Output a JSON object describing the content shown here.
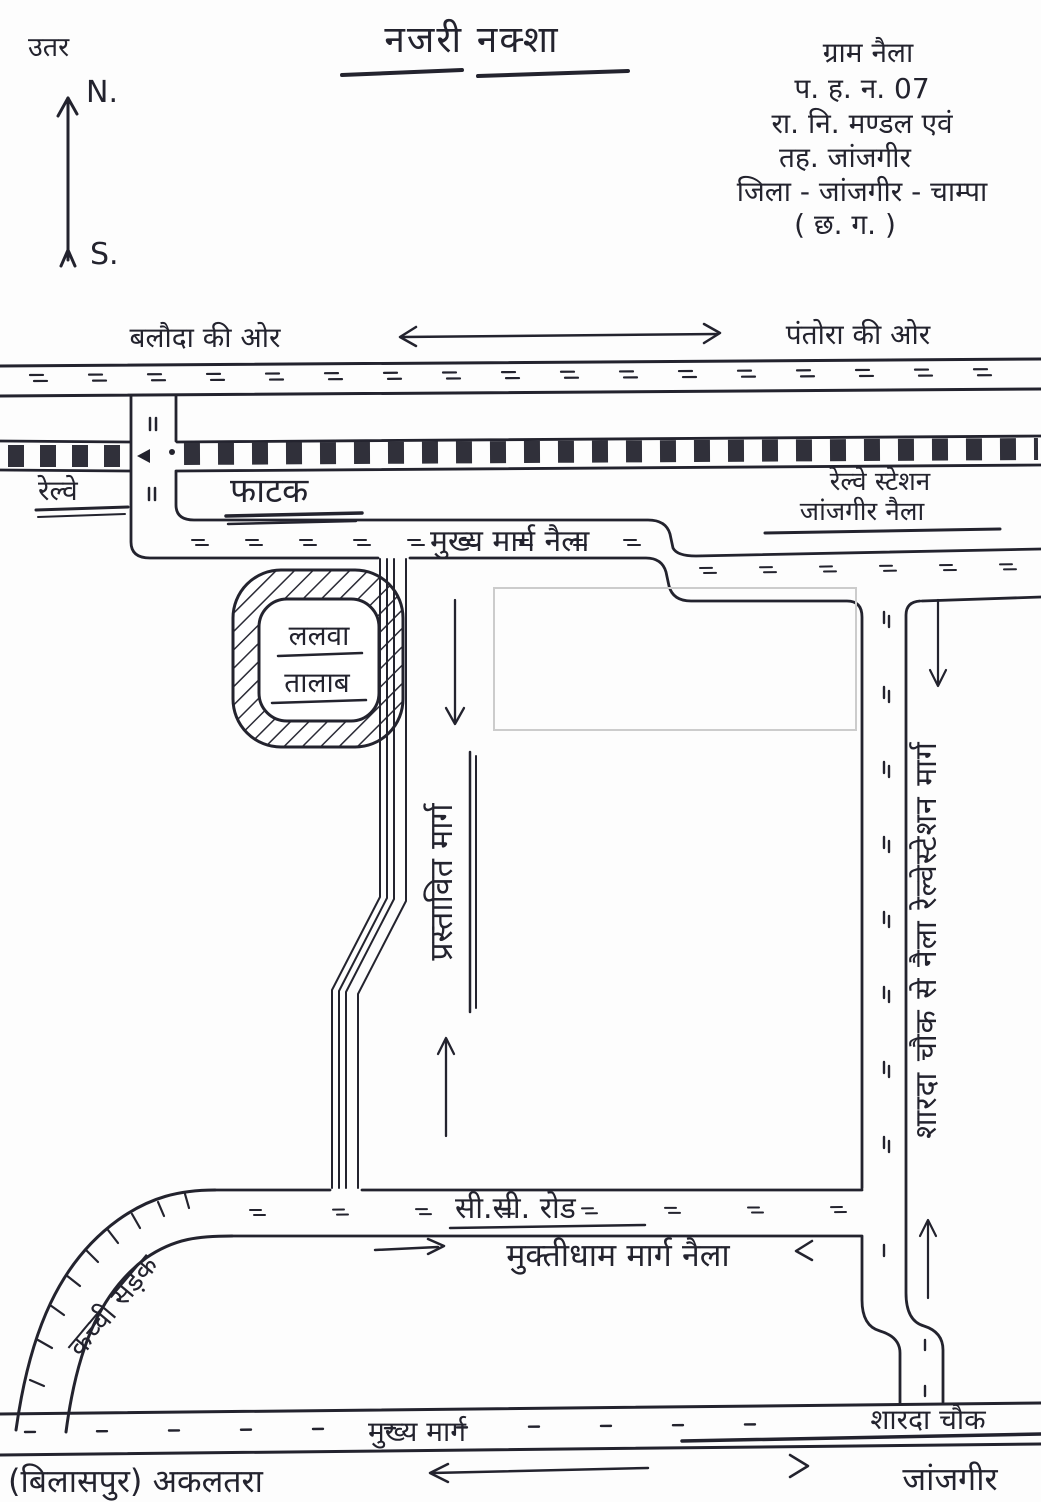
{
  "title": "नजरी नक्शा",
  "compass": {
    "label_hindi": "उतर",
    "north": "N.",
    "south": "S."
  },
  "address": {
    "lines": [
      "ग्राम नैला",
      "प. ह. न. 07",
      "रा. नि. मण्डल एवं",
      "तह. जांजगीर",
      "जिला - जांजगीर - चाम्पा",
      "( छ. ग. )"
    ]
  },
  "directions": {
    "left": "बलौदा की ओर",
    "right": "पंतोरा की ओर"
  },
  "railway": {
    "name": "रेल्वे",
    "gate": "फाटक",
    "station_line1": "रेल्वे स्टेशन",
    "station_line2": "जांजगीर नैला"
  },
  "roads": {
    "main_naila": "मुख्य मार्ग नैला",
    "proposed": "प्रस्तावित मार्ग",
    "station_road": "शारदा चौक से नैला रेल्वेस्टेशन मार्ग",
    "cc": "सी.सी. रोड",
    "muktidham": "मुक्तीधाम मार्ग नैला",
    "kachchi": "कच्ची सड़क",
    "main_bottom": "मुख्य मार्ग"
  },
  "places": {
    "pond_line1": "ललवा",
    "pond_line2": "तालाब",
    "sharda_chowk": "शारदा चौक",
    "janjgir": "जांजगीर",
    "akaltara": "(बिलासपुर) अकलतरा"
  },
  "colors": {
    "ink": "#23232e",
    "paper": "#fdfdfd",
    "faint_pencil": "#cccccc"
  }
}
